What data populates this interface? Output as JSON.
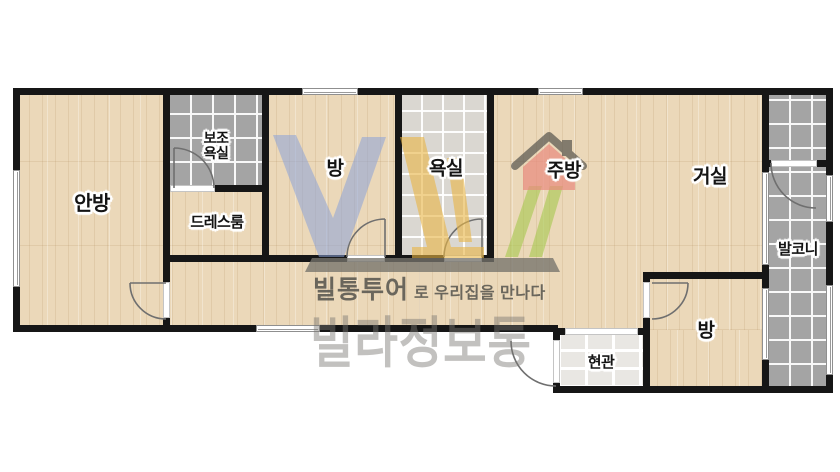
{
  "plan": {
    "rooms": {
      "master_bedroom": {
        "label": "안방"
      },
      "aux_bathroom": {
        "label": "보조\n욕실"
      },
      "dress_room": {
        "label": "드레스룸"
      },
      "room_top": {
        "label": "방"
      },
      "bathroom": {
        "label": "욕실"
      },
      "kitchen": {
        "label": "주방"
      },
      "living_room": {
        "label": "거실"
      },
      "balcony": {
        "label": "발코니"
      },
      "room_bottom": {
        "label": "방"
      },
      "entrance": {
        "label": "현관"
      }
    },
    "colors": {
      "wall_black": "#161616",
      "wood_floor": "#ebd8b9",
      "dark_tile": "#a4a4a4",
      "light_tile": "#dad7d1",
      "entry_tile": "#e9e7e3"
    }
  },
  "watermark": {
    "tagline_bold": "빌통투어",
    "tagline_rest": "로 우리집을 만나다",
    "brand": "빌라정보통",
    "logo_colors": {
      "letter_v_blue": "#8ba3d9",
      "letter_l_yellow": "#e9b544",
      "slashes_green": "#a6c94d",
      "house_body_red": "#e98a7e",
      "roof_gray": "#57544e",
      "base_bar_gray": "#76736c"
    }
  }
}
